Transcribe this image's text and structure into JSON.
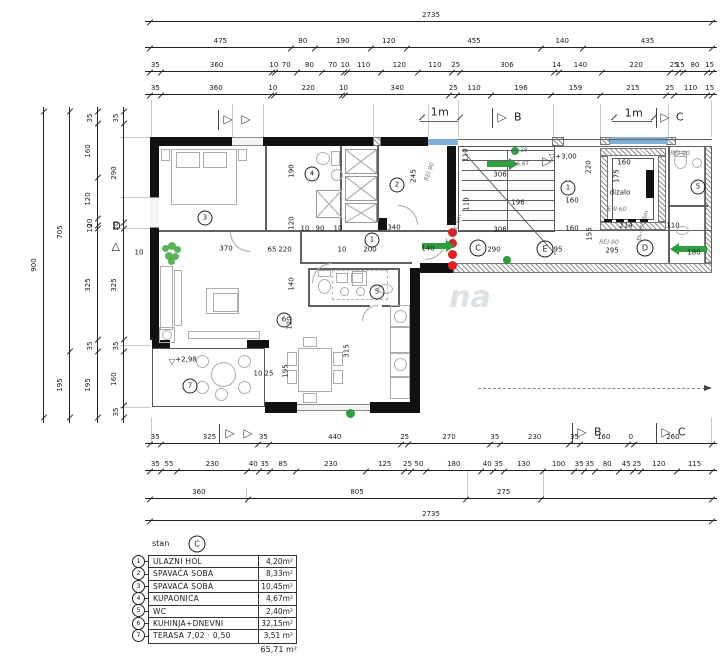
{
  "legend": {
    "unit_label": "stan",
    "unit_letter": "C",
    "rows": [
      {
        "num": "1",
        "name": "ULAZNI HOL",
        "area": "4,20m²"
      },
      {
        "num": "2",
        "name": "SPAVAĆA SOBA",
        "area": "8,33m²"
      },
      {
        "num": "3",
        "name": "SPAVAĆA SOBA",
        "area": "10,45m²"
      },
      {
        "num": "4",
        "name": "KUPAONICA",
        "area": "4,67m²"
      },
      {
        "num": "5",
        "name": "WC",
        "area": "2,40m²"
      },
      {
        "num": "6",
        "name": "KUHINJA+DNEVNI BORAVAK",
        "area": "32,15m²"
      },
      {
        "num": "7",
        "name": "TERASA 7,02 · 0,50",
        "area": "3,51 m²"
      }
    ],
    "total": "65,71 m²"
  },
  "dims": {
    "top": [
      [
        "2735"
      ],
      [
        "475",
        "80",
        "190",
        "120",
        "455",
        "140",
        "435"
      ],
      [
        "35",
        "360",
        "10",
        "70",
        "80",
        "70",
        "10",
        "110",
        "120",
        "110",
        "25",
        "306",
        "14",
        "140",
        "220",
        "25",
        "15",
        "80",
        "15"
      ],
      [
        "35",
        "360",
        "10",
        "220",
        "10",
        "340",
        "25",
        "110",
        "196",
        "159",
        "215",
        "25",
        "110",
        "15"
      ]
    ],
    "left": [
      [
        "900"
      ],
      [
        "705",
        "195"
      ],
      [
        "35",
        "160",
        "120",
        "20",
        "10",
        "325",
        "35",
        "195"
      ],
      [
        "35",
        "290",
        "20",
        "325",
        "35",
        "160",
        "35"
      ]
    ],
    "bottom": [
      [
        "35",
        "325",
        "35",
        "440",
        "25",
        "270",
        "35",
        "230",
        "35",
        "160",
        "0",
        "260"
      ],
      [
        "35",
        "55",
        "230",
        "40",
        "35",
        "85",
        "230",
        "125",
        "25",
        "50",
        "180",
        "40",
        "35",
        "130",
        "100",
        "35",
        "35",
        "80",
        "45",
        "25",
        "120",
        "115"
      ],
      [
        "360",
        "805",
        "275",
        ""
      ],
      [
        "2735"
      ]
    ]
  },
  "plan_labels": [
    [
      "370",
      226,
      249,
      "d",
      0
    ],
    [
      "190",
      292,
      171,
      "d",
      -90
    ],
    [
      "120",
      292,
      223,
      "d",
      -90
    ],
    [
      "140",
      292,
      284,
      "d",
      -90
    ],
    [
      "120",
      290,
      323,
      "d",
      -90
    ],
    [
      "195",
      286,
      371,
      "d",
      -90
    ],
    [
      "315",
      347,
      351,
      "d",
      -90
    ],
    [
      "10",
      258,
      374,
      "d",
      0
    ],
    [
      "25",
      269,
      374,
      "d",
      0
    ],
    [
      "10",
      305,
      229,
      "d",
      0
    ],
    [
      "90",
      320,
      229,
      "d",
      0
    ],
    [
      "10",
      338,
      229,
      "d",
      0
    ],
    [
      "340",
      394,
      228,
      "d",
      0
    ],
    [
      "245",
      414,
      176,
      "d",
      -90
    ],
    [
      "65",
      272,
      250,
      "d",
      0
    ],
    [
      "220",
      285,
      250,
      "d",
      0
    ],
    [
      "10",
      342,
      250,
      "d",
      0
    ],
    [
      "200",
      370,
      250,
      "d",
      0
    ],
    [
      "140",
      428,
      249,
      "d",
      0
    ],
    [
      "306",
      500,
      175,
      "d",
      0
    ],
    [
      "196",
      518,
      203,
      "d",
      0
    ],
    [
      "306",
      500,
      230,
      "d",
      0
    ],
    [
      "110",
      466,
      155,
      "d",
      -90
    ],
    [
      "110",
      467,
      204,
      "d",
      -90
    ],
    [
      "290",
      494,
      250,
      "d",
      0
    ],
    [
      "95",
      558,
      250,
      "d",
      0
    ],
    [
      "220",
      589,
      167,
      "d",
      -90
    ],
    [
      "160",
      572,
      201,
      "d",
      0
    ],
    [
      "160",
      572,
      229,
      "d",
      0
    ],
    [
      "155",
      590,
      234,
      "d",
      -90
    ],
    [
      "214",
      626,
      226,
      "d",
      0
    ],
    [
      "295",
      612,
      251,
      "d",
      0
    ],
    [
      "110",
      673,
      226,
      "d",
      0
    ],
    [
      "180",
      694,
      253,
      "d",
      0
    ],
    [
      "160",
      624,
      163,
      "d",
      0
    ],
    [
      "175",
      617,
      176,
      "d",
      -90
    ],
    [
      "28",
      524,
      151,
      "tiny",
      0
    ],
    [
      "16,67",
      521,
      165,
      "tiny",
      0
    ],
    [
      "dizalo",
      620,
      193,
      "d",
      0
    ],
    [
      "EW-60",
      617,
      210,
      "fire",
      0
    ],
    [
      "REI-90",
      680,
      154,
      "fire",
      0
    ],
    [
      "REI-90",
      609,
      243,
      "fire",
      0
    ],
    [
      "REI 90",
      430,
      172,
      "fire",
      -70
    ],
    [
      "EI₂-35C-Sm",
      457,
      230,
      "tiny",
      -75
    ],
    [
      "EI₂-35C-Sm",
      644,
      226,
      "tiny",
      -75
    ],
    [
      "+3,00",
      566,
      157,
      "lev",
      0
    ],
    [
      "▽",
      552,
      157,
      "lev2",
      0
    ],
    [
      "+2,98",
      186,
      360,
      "lev",
      0
    ],
    [
      "▽",
      172,
      362,
      "lev2",
      0
    ],
    [
      "1m",
      440,
      112,
      "mkl",
      0
    ],
    [
      "1m",
      634,
      113,
      "mkl",
      0
    ],
    [
      "D",
      117,
      226,
      "mkl",
      0
    ],
    [
      "△",
      116,
      246,
      "mkl",
      0
    ],
    [
      "10",
      139,
      253,
      "d",
      0
    ],
    [
      "▷",
      228,
      119,
      "mk",
      0
    ],
    [
      "▷",
      246,
      119,
      "mk",
      0
    ],
    [
      "▷",
      502,
      117,
      "mk",
      0
    ],
    [
      "B",
      518,
      117,
      "mkl",
      0
    ],
    [
      "▷",
      665,
      117,
      "mk",
      0
    ],
    [
      "C",
      680,
      117,
      "mkl",
      0
    ],
    [
      "▷",
      230,
      433,
      "mk",
      0
    ],
    [
      "▷",
      248,
      433,
      "mk",
      0
    ],
    [
      "▷",
      582,
      432,
      "mk",
      0
    ],
    [
      "B",
      598,
      432,
      "mkl",
      0
    ],
    [
      "▷",
      666,
      432,
      "mk",
      0
    ],
    [
      "C",
      682,
      432,
      "mkl",
      0
    ],
    [
      "▷",
      547,
      161,
      "mk",
      0
    ],
    [
      "na",
      470,
      298,
      "wm",
      0
    ]
  ],
  "room_circles": [
    [
      "3",
      205,
      218
    ],
    [
      "4",
      312,
      174
    ],
    [
      "2",
      397,
      185
    ],
    [
      "1",
      372,
      240
    ],
    [
      "5",
      377,
      292
    ],
    [
      "6",
      284,
      320
    ],
    [
      "7",
      190,
      386
    ],
    [
      "1",
      568,
      188
    ],
    [
      "5",
      698,
      187
    ]
  ],
  "axis_circles": [
    [
      "C",
      478,
      248
    ],
    [
      "E",
      545,
      249
    ],
    [
      "D",
      645,
      248
    ]
  ],
  "colors": {
    "wall": "#111111",
    "window_blue": "#7fb0d8",
    "arrow_green": "#2f9e3f",
    "dot_red": "#e02222"
  }
}
